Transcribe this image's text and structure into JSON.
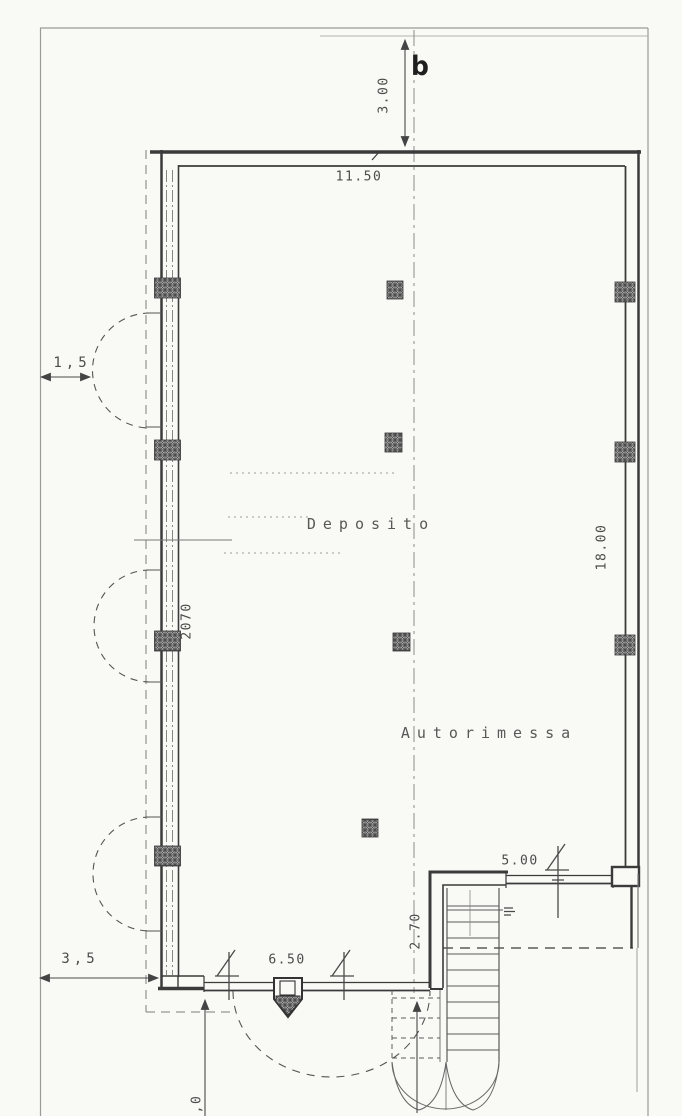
{
  "title": "Scanned floor plan",
  "rooms": {
    "deposito": "Deposito",
    "autorimessa": "Autorimessa"
  },
  "dimensions": {
    "front_setback": "3.00",
    "plan_width": "11.50",
    "side_setback_upper": "1,5",
    "left_opening": "2070",
    "plan_depth": "18.00",
    "side_setback_lower": "3,5",
    "gate_width": "6.50",
    "rear_opening": "5.00",
    "stair_width": "2.70",
    "bottom_partial": ",0"
  },
  "markers": {
    "section_label": "b"
  },
  "colors": {
    "paper": "#f9f9f5",
    "ink": "#3b3b3b",
    "ink_light": "#8c8c8c",
    "text": "#4c4c4c",
    "hatch_bg": "#cbcbcb"
  }
}
